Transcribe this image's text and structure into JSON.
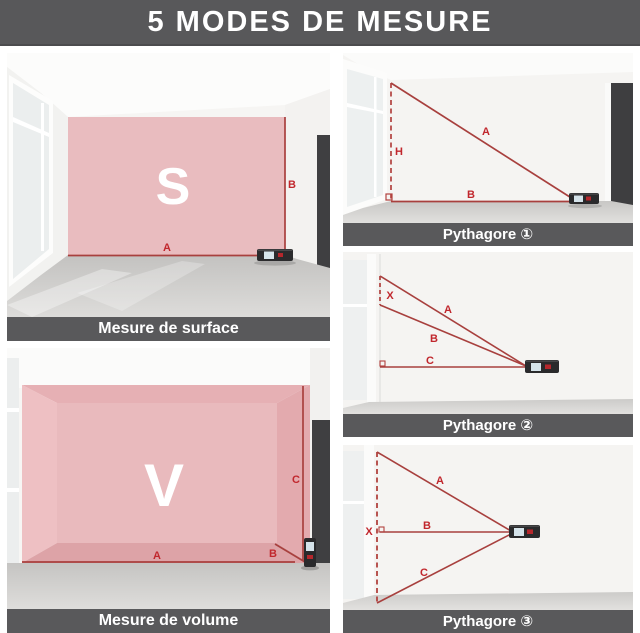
{
  "header": {
    "title": "5 MODES DE MESURE"
  },
  "panels": {
    "surface": {
      "caption": "Mesure de surface",
      "symbol": "S",
      "label_a": "A",
      "label_b": "B"
    },
    "volume": {
      "caption": "Mesure de volume",
      "symbol": "V",
      "label_a": "A",
      "label_b": "B",
      "label_c": "C"
    },
    "pyth1": {
      "caption": "Pythagore ①",
      "label_h": "H",
      "label_a": "A",
      "label_b": "B"
    },
    "pyth2": {
      "caption": "Pythagore ②",
      "label_x": "X",
      "label_a": "A",
      "label_b": "B",
      "label_c": "C"
    },
    "pyth3": {
      "caption": "Pythagore ③",
      "label_x": "X",
      "label_a": "A",
      "label_b": "B",
      "label_c": "C"
    }
  },
  "icons": {
    "device": "laser-distance-meter"
  },
  "colors": {
    "banner_bg": "#58585a",
    "caption_bg": "#59595b",
    "pink_wall": "#e9bcbf",
    "line_red": "#a8403e",
    "label_red": "#c1272d",
    "doorway_dark": "#3f3f41"
  }
}
